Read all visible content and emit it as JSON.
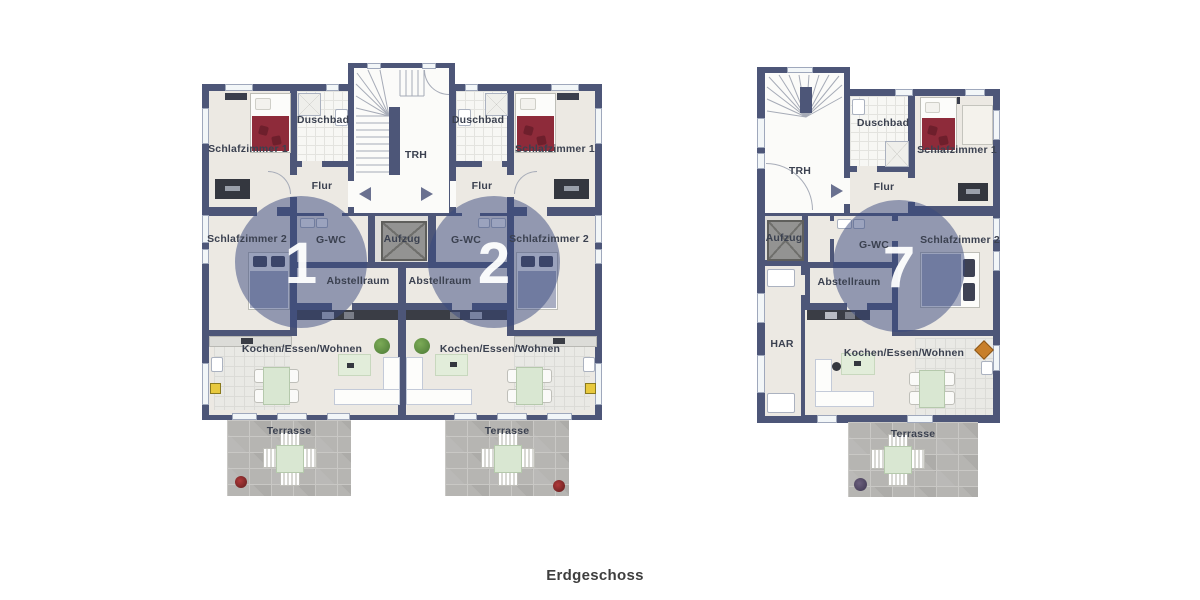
{
  "caption": "Erdgeschoss",
  "colors": {
    "wall": "#4D5678",
    "floor": "#ECE9E3",
    "floor_light": "#FBFBF9",
    "terrace": "#B6B5B2",
    "unit_circle": "#38477E",
    "accent_red": "#8E2B3A",
    "table_green": "#D9E7D2"
  },
  "left_building": {
    "trh": "TRH",
    "aufzug": "Aufzug",
    "unit1": {
      "number": "1",
      "schlafzimmer1": "Schlafzimmer 1",
      "duschbad": "Duschbad",
      "flur": "Flur",
      "schlafzimmer2": "Schlafzimmer 2",
      "gwc": "G-WC",
      "abstellraum": "Abstellraum",
      "kochen": "Kochen/Essen/Wohnen",
      "terrasse": "Terrasse"
    },
    "unit2": {
      "number": "2",
      "schlafzimmer1": "Schlafzimmer 1",
      "duschbad": "Duschbad",
      "flur": "Flur",
      "schlafzimmer2": "Schlafzimmer 2",
      "gwc": "G-WC",
      "abstellraum": "Abstellraum",
      "kochen": "Kochen/Essen/Wohnen",
      "terrasse": "Terrasse"
    }
  },
  "right_building": {
    "trh": "TRH",
    "aufzug": "Aufzug",
    "har": "HAR",
    "unit7": {
      "number": "7",
      "schlafzimmer1": "Schlafzimmer 1",
      "duschbad": "Duschbad",
      "flur": "Flur",
      "schlafzimmer2": "Schlafzimmer 2",
      "gwc": "G-WC",
      "abstellraum": "Abstellraum",
      "kochen": "Kochen/Essen/Wohnen",
      "terrasse": "Terrasse"
    }
  }
}
